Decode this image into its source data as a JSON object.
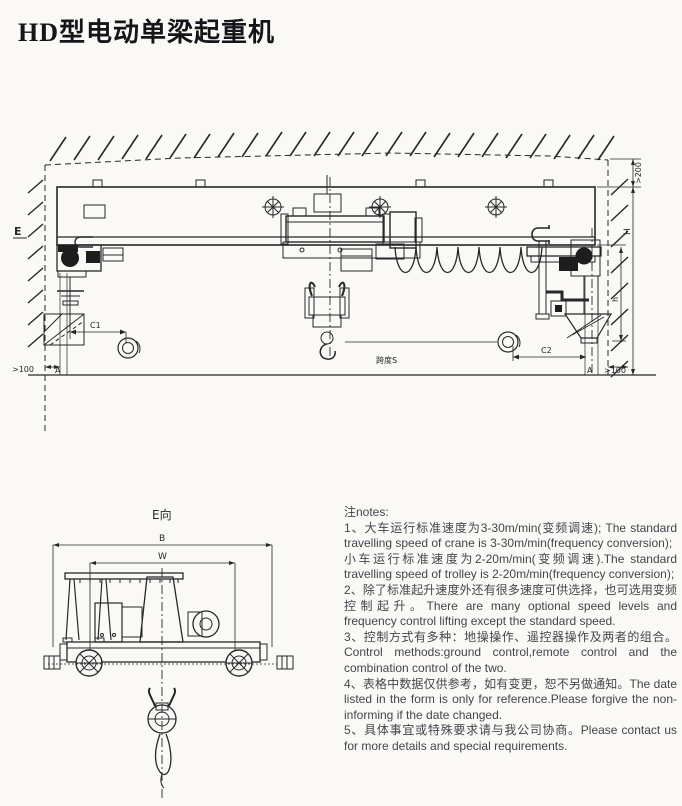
{
  "page": {
    "title": "HD型电动单梁起重机"
  },
  "front_view": {
    "labels": {
      "view_direction": "E",
      "left_clearance": ">100",
      "rail_left": "A",
      "hook_approach_left": "C1",
      "span": "跨度S",
      "hook_approach_right": "C2",
      "rail_right": "A",
      "right_clearance": ">100",
      "top_clearance": ">200",
      "crane_height": "H",
      "headroom": "h"
    }
  },
  "side_view": {
    "labels": {
      "view_label": "E向",
      "overall_width": "B",
      "wheel_base": "W"
    }
  },
  "notes": {
    "heading": "注notes:",
    "items": [
      "1、大车运行标准速度为3-30m/min(变频调速); The standard travelling speed of crane is 3-30m/min(frequency conversion);",
      "小车运行标准速度为2-20m/min(变频调速).The standard travelling speed of trolley is 2-20m/min(frequency conversion);",
      "2、除了标准起升速度外还有很多速度可供选择，也可选用变频控制起升。There are many optional speed levels and frequency control lifting except the standard speed.",
      "3、控制方式有多种：地操操作、遥控器操作及两者的组合。Control methods:ground control,remote control and the combination control of the two.",
      "4、表格中数据仅供参考，如有变更，恕不另做通知。The date listed in the form is only for reference.Please forgive the non-informing if the  date changed.",
      "5、具体事宜或特殊要求请与我公司协商。Please contact us for more details and special requirements."
    ]
  }
}
